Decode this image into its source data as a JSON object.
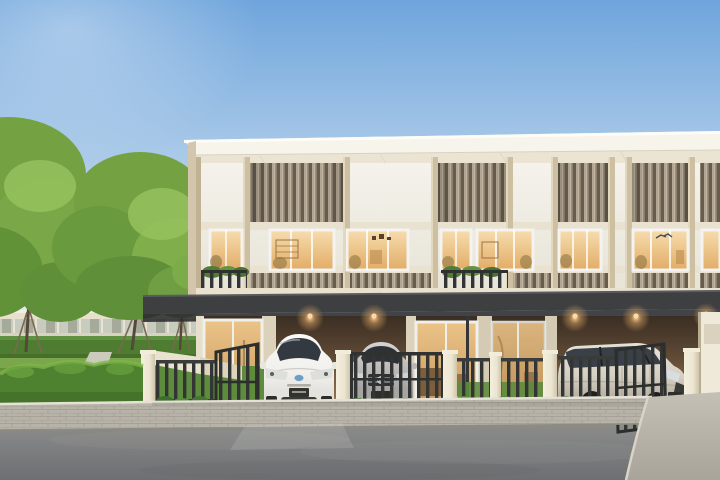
{
  "meta": {
    "type": "architectural-render",
    "subject": "Modern two-storey townhouse row at dusk with interior lights on",
    "setting": "Landscaped suburban street, three parked cars, garden with mature trees"
  },
  "scene": {
    "building": {
      "storeys": 2,
      "roof": "flat white fascia with deep eave",
      "facade": [
        "white frosted panels",
        "vertical bronze louvre slat panels",
        "beige pillars"
      ],
      "upper_floor": [
        "warm-lit picture windows",
        "balconies with dark railings and planters"
      ],
      "ground_floor": [
        "dark steel carport canopy",
        "recessed carports with warm downlights",
        "glass entry doors"
      ],
      "downlights_visible": 5
    },
    "vehicles": [
      {
        "name": "white-hatchback",
        "position": "first carport, gate open"
      },
      {
        "name": "silver-sedan",
        "position": "second carport, behind closed gate"
      },
      {
        "name": "champagne-mpv",
        "position": "right carport, gate open"
      }
    ],
    "landscape": [
      "two large trees with staked trunks",
      "trimmed foreground hedge",
      "rear hedge wall",
      "lawn with garden path",
      "shrub border along fence",
      "distant single-storey clubhouse"
    ],
    "street": [
      "paver sidewalk strip",
      "concrete driveway apron",
      "asphalt road"
    ],
    "fence": {
      "style": "dark vertical steel bars between cream masonry posts",
      "gates": [
        "open left gate",
        "closed centre gate",
        "open right gate"
      ]
    }
  },
  "colors": {
    "sky_top": "#6FA5DC",
    "sky_mid": "#A9C9E8",
    "sky_low": "#D9E6EF",
    "sky_horizon": "#F0F3F1",
    "roof_fascia": "#F7F4EC",
    "soffit": "#EBE4D3",
    "facade_white": "#F4F2EB",
    "facade_white_dim": "#E7E3D7",
    "pillar": "#CDBFA2",
    "slat_light": "#B2A692",
    "slat_mid": "#8D8170",
    "slat_dark": "#675D4F",
    "transom": "#E9E2D0",
    "window_frame": "#F4F3EF",
    "glass_warm": "#F7DDAF",
    "glass_amber": "#E2AC66",
    "glass_dark": "#2E3237",
    "slab": "#E9E2CF",
    "awning": "#3E3F41",
    "awning_edge": "#5A5B5E",
    "awning_shadow": "#2A2B2D",
    "carport_top": "#3A2E23",
    "carport_mid": "#8A6A4B",
    "carport_low": "#A8845F",
    "door_glass_top": "#ECC488",
    "door_glass_low": "#C89A60",
    "downlight": "#FFD9A4",
    "fence_bar": "#333534",
    "fence_post": "#ECE5D2",
    "hedge": "#4F8230",
    "hedge_light": "#7FB549",
    "hedge_dark": "#3F6B27",
    "back_hedge": "#4E7C31",
    "lawn": "#7BA64C",
    "path": "#CCC9BD",
    "tree_main": "#74A243",
    "tree_light": "#95C25D",
    "tree_dark": "#5F8F38",
    "trunk": "#554838",
    "stake": "#7A6850",
    "houses_wall": "#E6E0CD",
    "car_white": "#F0EFEC",
    "car_silver": "#B7B6B4",
    "car_champagne": "#D6D0C4",
    "walk_paver": "#B7B3A8",
    "paver_line": "#A19D92",
    "apron": "#C4C0B6",
    "asphalt_top": "#96978F",
    "asphalt_low": "#6E6F72",
    "right_wall": "#EFE9D9"
  }
}
